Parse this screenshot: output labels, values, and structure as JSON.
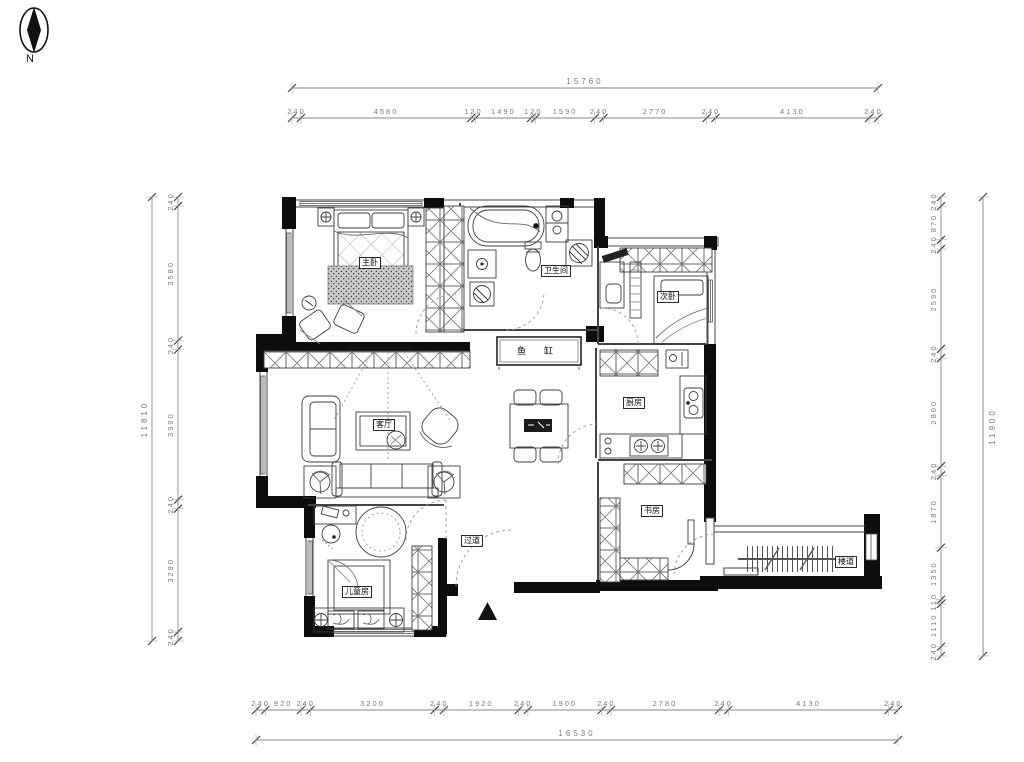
{
  "north_label": "N",
  "colors": {
    "wall": "#0d0d0d",
    "line": "#4a4a4a",
    "dim_text": "#7a7a7a",
    "background": "#ffffff"
  },
  "dimensions": {
    "top": {
      "total": "15760",
      "segments": [
        "240",
        "4580",
        "120",
        "1490",
        "120",
        "1590",
        "240",
        "2770",
        "240",
        "4130",
        "240"
      ]
    },
    "bottom": {
      "total": "16530",
      "segments": [
        "240",
        "920",
        "240",
        "3200",
        "240",
        "1920",
        "240",
        "1900",
        "240",
        "2780",
        "240",
        "4130",
        "240"
      ]
    },
    "left": {
      "total": "11810",
      "segments": [
        "240",
        "3580",
        "240",
        "3990",
        "240",
        "3280",
        "240"
      ]
    },
    "right": {
      "total": "11900",
      "segments": [
        "240",
        "870",
        "240",
        "2590",
        "240",
        "2800",
        "240",
        "1870",
        "1350",
        "110",
        "1110",
        "240"
      ]
    }
  },
  "rooms": {
    "master_bedroom": "主卧",
    "bathroom": "卫生间",
    "second_bedroom": "次卧",
    "living_room": "客厅",
    "fish_tank": "鱼缸",
    "kitchen": "厨房",
    "study": "书房",
    "hallway": "过道",
    "kids_room": "儿童房",
    "corridor": "楼道"
  }
}
